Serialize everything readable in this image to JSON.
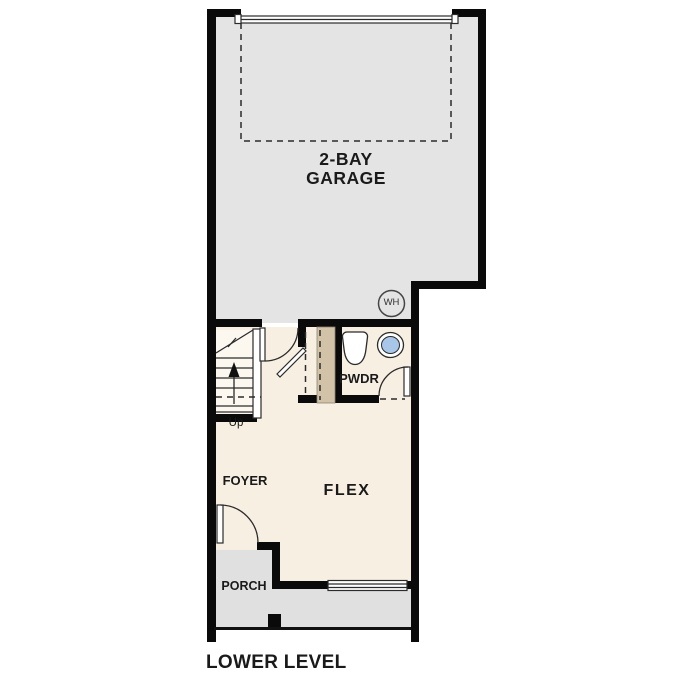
{
  "title": "LOWER LEVEL",
  "rooms": {
    "garage": {
      "label_line1": "2-BAY",
      "label_line2": "GARAGE"
    },
    "powder": {
      "label": "PWDR"
    },
    "foyer": {
      "label": "FOYER"
    },
    "flex": {
      "label": "FLEX"
    },
    "porch": {
      "label": "PORCH"
    }
  },
  "annotations": {
    "water_heater": "WH",
    "stairs_direction": "Up"
  },
  "colors": {
    "wall": "#0a0a0a",
    "line": "#2b2b2b",
    "text": "#1a1a1a",
    "garage_fill": "#e4e4e4",
    "interior_fill": "#f7efe2",
    "porch_fill": "#e0e0e0",
    "stairs_fill": "#fcf8f0",
    "tan_wall": "#d2c3a8",
    "sink_blue": "#a7c6e8"
  }
}
